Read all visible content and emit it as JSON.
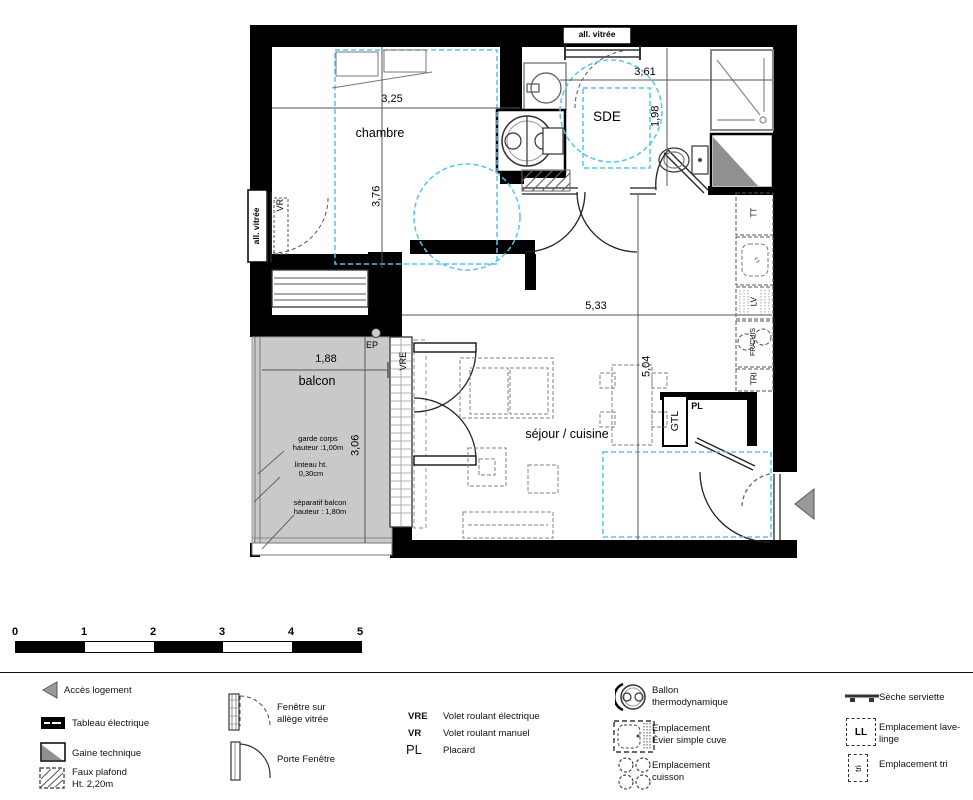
{
  "plan": {
    "room_labels": {
      "chambre": "chambre",
      "sde": "SDE",
      "sejour": "séjour / cuisine",
      "balcon": "balcon"
    },
    "dimensions": {
      "chambre_width": "3,25",
      "chambre_depth": "3,76",
      "sde_width": "3,61",
      "sde_depth": "1,98",
      "sejour_width": "5,33",
      "sejour_depth": "5,04",
      "balcon_width": "1,88",
      "balcon_depth": "3,06"
    },
    "wall_labels": {
      "all_vitree_top": "all. vitrée",
      "all_vitree_left": "all. vitrée",
      "vr": "VR",
      "vre": "VRE",
      "ep": "EP",
      "tt": "TT",
      "lv": "LV",
      "fr_cuis": "FR/CUIS",
      "tri": "TRI",
      "gtl": "GTL",
      "pl": "PL"
    },
    "annotations": {
      "garde_corps": "garde corps\nhauteur :1,00m",
      "linteau": "linteau ht.\n0,30cm",
      "separatif": "séparatif balcon\nhauteur : 1,80m"
    }
  },
  "scale_bar": {
    "ticks": [
      "0",
      "1",
      "2",
      "3",
      "4",
      "5"
    ]
  },
  "legend": {
    "access": "Accès  logement",
    "tableau": "Tableau électrique",
    "gaine": "Gaine technique",
    "faux_plafond": "Faux plafond\nHt. 2,20m",
    "fenetre": "Fenêtre sur\nallège vitrée",
    "porte_fenetre": "Porte Fenêtre",
    "vre_abbr": "VRE",
    "vre_desc": "Volet roulant électrique",
    "vr_abbr": "VR",
    "vr_desc": "Volet roulant manuel",
    "pl_abbr": "PL",
    "pl_desc": "Placard",
    "ballon": "Ballon\nthermodynamique",
    "evier": "Emplacement\nÉvier simple cuve",
    "cuisson": "Emplacement\ncuisson",
    "seche": "Sèche serviette",
    "lave_linge": "Emplacement lave-\nlinge",
    "tri": "Emplacement tri",
    "ll_icon_label": "LL",
    "tri_icon_label": "tri"
  },
  "colors": {
    "wall": "#000000",
    "accessibility_zone": "#55c6ee",
    "balcony_fill": "#c9c9c9",
    "technical_gray": "#909090"
  }
}
